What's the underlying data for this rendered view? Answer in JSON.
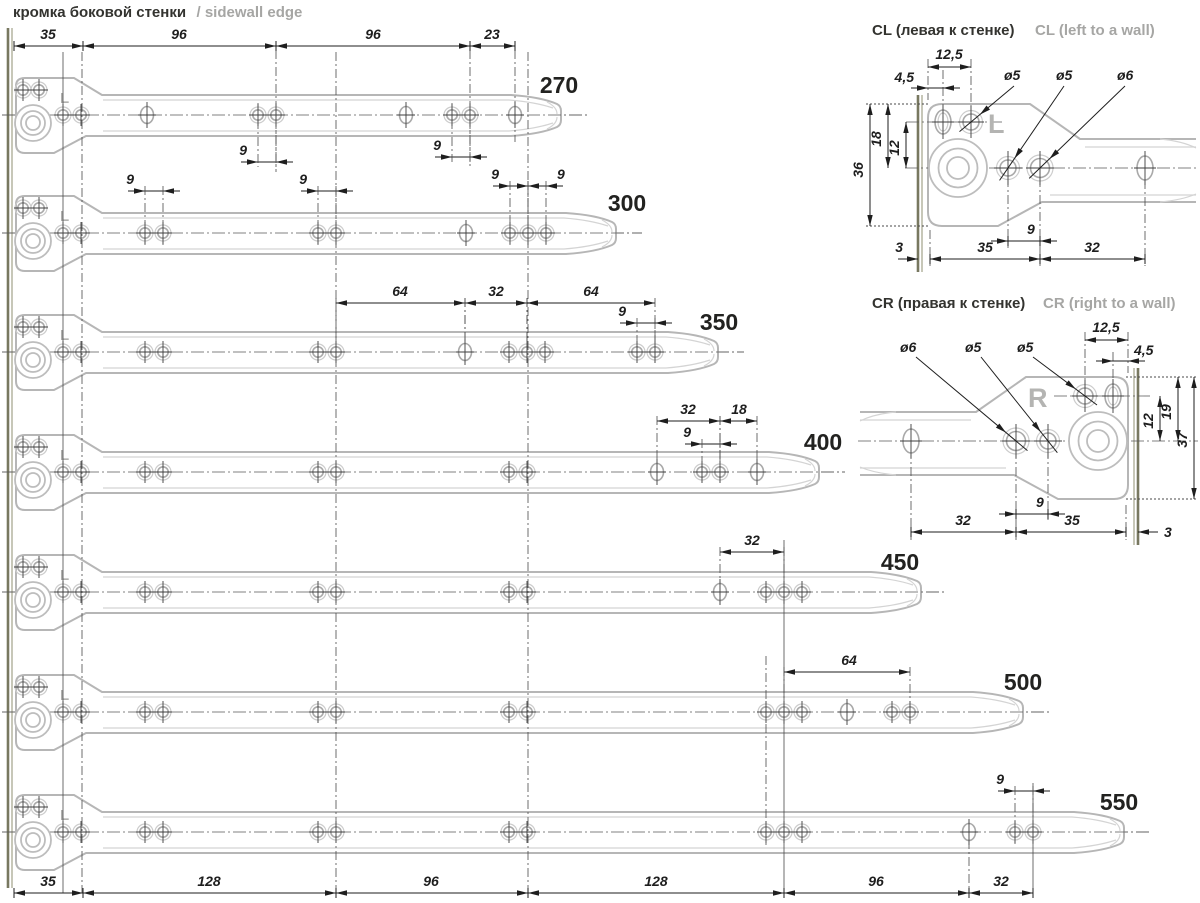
{
  "title": {
    "ru": "кромка боковой стенки",
    "en": "/ sidewall edge"
  },
  "top_chain": [
    "35",
    "96",
    "96",
    "23"
  ],
  "bottom_chain": [
    "35",
    "128",
    "96",
    "128",
    "96",
    "32"
  ],
  "slides": [
    {
      "size": "270",
      "marking": "L",
      "dims": [
        "9",
        "9"
      ]
    },
    {
      "size": "300",
      "marking": "L",
      "dims": [
        "9",
        "9",
        "9",
        "9"
      ]
    },
    {
      "size": "350",
      "marking": "L",
      "dims": [
        "64",
        "32",
        "64",
        "9"
      ]
    },
    {
      "size": "400",
      "marking": "L",
      "dims": [
        "32",
        "18",
        "9"
      ]
    },
    {
      "size": "450",
      "marking": "L",
      "dims": [
        "32"
      ]
    },
    {
      "size": "500",
      "marking": "L",
      "dims": [
        "64"
      ]
    },
    {
      "size": "550",
      "marking": "L",
      "dims": [
        "9"
      ]
    }
  ],
  "details": [
    {
      "id": "CL",
      "title_ru": "CL (левая к стенке)",
      "title_en": "CL (left to a wall)",
      "marking": "L",
      "top_dims": [
        "12,5",
        "4,5"
      ],
      "hole_labels": [
        "ø5",
        "ø5",
        "ø6"
      ],
      "side_dims": [
        "36",
        "18",
        "12"
      ],
      "chain_dims": [
        "3",
        "35",
        "9",
        "32"
      ]
    },
    {
      "id": "CR",
      "title_ru": "CR (правая к стенке)",
      "title_en": "CR (right to a wall)",
      "marking": "R",
      "top_dims": [
        "12,5",
        "4,5"
      ],
      "hole_labels": [
        "ø6",
        "ø5",
        "ø5"
      ],
      "side_dims": [
        "12",
        "19",
        "37"
      ],
      "chain_dims": [
        "32",
        "9",
        "35",
        "3"
      ]
    }
  ],
  "colors": {
    "outline": "#b6b6b6",
    "dimension": "#1e1e1e",
    "sidewall_edge": "#787860",
    "grey_text": "#a6a6a4"
  }
}
